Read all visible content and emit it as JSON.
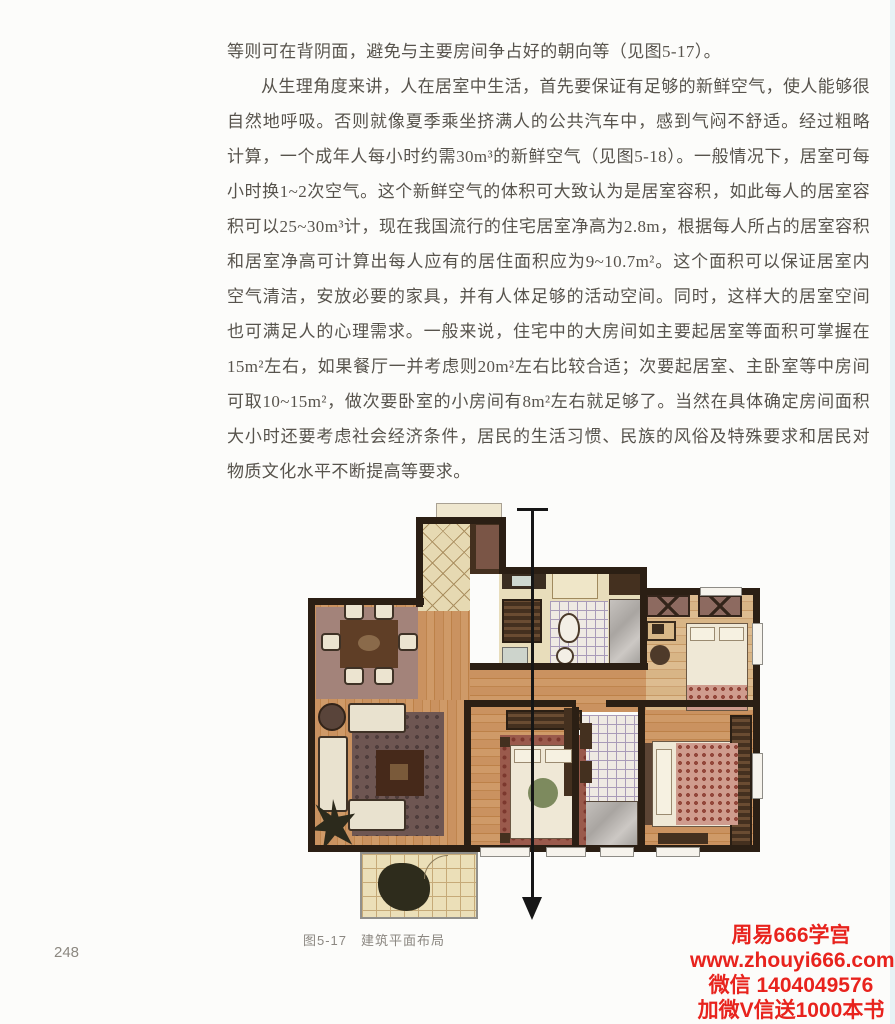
{
  "page": {
    "number": "248",
    "body": {
      "paragraph1": "等则可在背阴面，避免与主要房间争占好的朝向等（见图5-17）。",
      "paragraph2": "从生理角度来讲，人在居室中生活，首先要保证有足够的新鲜空气，使人能够很自然地呼吸。否则就像夏季乘坐挤满人的公共汽车中，感到气闷不舒适。经过粗略计算，一个成年人每小时约需30m³的新鲜空气（见图5-18）。一般情况下，居室可每小时换1~2次空气。这个新鲜空气的体积可大致认为是居室容积，如此每人的居室容积可以25~30m³计，现在我国流行的住宅居室净高为2.8m，根据每人所占的居室容积和居室净高可计算出每人应有的居住面积应为9~10.7m²。这个面积可以保证居室内空气清洁，安放必要的家具，并有人体足够的活动空间。同时，这样大的居室空间也可满足人的心理需求。一般来说，住宅中的大房间如主要起居室等面积可掌握在15m²左右，如果餐厅一并考虑则20m²左右比较合适；次要起居室、主卧室等中房间可取10~15m²，做次要卧室的小房间有8m²左右就足够了。当然在具体确定房间面积大小时还要考虑社会经济条件，居民的生活习惯、民族的风俗及特殊要求和居民对物质文化水平不断提高等要求。"
    },
    "figure": {
      "caption": "图5-17　建筑平面布局",
      "type": "floorplan-watercolor",
      "section_arrow": "vertical section line through plan, T-bar top, arrowhead bottom"
    },
    "watermark": {
      "line1": "周易666学宫",
      "line2": "www.zhouyi666.com",
      "line3": "微信 1404049576",
      "line4": "加微V信送1000本书",
      "color": "#e8231d"
    }
  },
  "colors": {
    "body_text": "#57534c",
    "caption_text": "#8b8781",
    "plan_wall": "#2b1f14",
    "plan_wood": "#c8905c",
    "plan_cream_tile": "#e8ddbb",
    "rug_maroon": "#9a5a4c"
  }
}
